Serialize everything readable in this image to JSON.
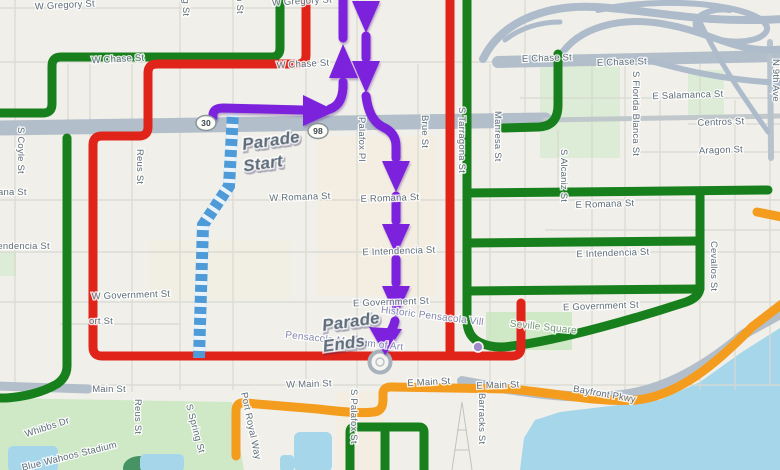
{
  "map": {
    "title": "Pensacola parade route map",
    "annotations": {
      "start_line1": "Parade",
      "start_line2": "Start",
      "ends_line1": "Parade",
      "ends_line2": "Ends"
    },
    "colors": {
      "parade_purple": "#7c22dd",
      "closure_red": "#e02419",
      "route_green": "#17801c",
      "route_orange": "#f49c1e",
      "staging_blue": "#4e9bd8",
      "road_gray": "#b2bfca",
      "ramp_gray": "#adbbcb",
      "water": "#a6d6ea",
      "park": "#cfe8c6",
      "background": "#f1efe9",
      "label_gray": "#5f6e7a",
      "parade_start_text": "#6d22c0",
      "parade_ends_text": "#4632ae"
    },
    "shields": [
      {
        "label": "30",
        "x": 206,
        "y": 123
      },
      {
        "label": "98",
        "x": 318,
        "y": 131
      }
    ],
    "street_labels": [
      {
        "text": "W Gregory St",
        "x": 65,
        "y": 8,
        "rot": -3
      },
      {
        "text": "W Gregory St",
        "x": 302,
        "y": 4,
        "rot": -3
      },
      {
        "text": "W Chase St",
        "x": 118,
        "y": 62,
        "rot": -3
      },
      {
        "text": "W Chase St",
        "x": 303,
        "y": 67,
        "rot": -3
      },
      {
        "text": "E Chase St",
        "x": 547,
        "y": 61,
        "rot": -2
      },
      {
        "text": "E Chase St",
        "x": 622,
        "y": 65,
        "rot": -2
      },
      {
        "text": "E Salamanca St",
        "x": 688,
        "y": 98,
        "rot": -2
      },
      {
        "text": "Centros St",
        "x": 721,
        "y": 125,
        "rot": -2
      },
      {
        "text": "Aragon St",
        "x": 721,
        "y": 153,
        "rot": -2
      },
      {
        "text": "W Romana St",
        "x": -4,
        "y": 195,
        "rot": 0
      },
      {
        "text": "W Romana St",
        "x": 300,
        "y": 200,
        "rot": -2
      },
      {
        "text": "E Romana St",
        "x": 390,
        "y": 201,
        "rot": -2
      },
      {
        "text": "E Romana St",
        "x": 605,
        "y": 207,
        "rot": -2
      },
      {
        "text": "W Intendencia St",
        "x": 12,
        "y": 249,
        "rot": 0
      },
      {
        "text": "E Intendencia St",
        "x": 399,
        "y": 254,
        "rot": -2
      },
      {
        "text": "E Intendencia St",
        "x": 613,
        "y": 256,
        "rot": -2
      },
      {
        "text": "W Government St",
        "x": 131,
        "y": 298,
        "rot": -2
      },
      {
        "text": "E Government St",
        "x": 391,
        "y": 305,
        "rot": -2
      },
      {
        "text": "E Government St",
        "x": 601,
        "y": 309,
        "rot": -2
      },
      {
        "text": "ort St",
        "x": 101,
        "y": 324,
        "rot": 0
      },
      {
        "text": "Main St",
        "x": 109,
        "y": 392,
        "rot": 0
      },
      {
        "text": "W Main St",
        "x": 309,
        "y": 387,
        "rot": -2
      },
      {
        "text": "E Main St",
        "x": 429,
        "y": 385,
        "rot": -3
      },
      {
        "text": "E Main St",
        "x": 498,
        "y": 388,
        "rot": -2
      },
      {
        "text": "Bayfront Pkwy",
        "x": 604,
        "y": 397,
        "rot": 10
      },
      {
        "text": "Whibbs Dr",
        "x": 48,
        "y": 430,
        "rot": -18
      },
      {
        "text": "Blue Wahoos Stadium",
        "x": 70,
        "y": 459,
        "rot": -14
      },
      {
        "text": "S Coyle St",
        "x": 18,
        "y": 127,
        "rot": 90,
        "anchor": "start"
      },
      {
        "text": "Reus St",
        "x": 137,
        "y": 149,
        "rot": 90,
        "anchor": "start"
      },
      {
        "text": "S Spring St",
        "x": 183,
        "y": -34,
        "rot": 90,
        "anchor": "start"
      },
      {
        "text": "S Baylen St",
        "x": 237,
        "y": -38,
        "rot": 90,
        "anchor": "start"
      },
      {
        "text": "Palafox Pl",
        "x": 359,
        "y": 117,
        "rot": 90,
        "anchor": "start"
      },
      {
        "text": "Brue St",
        "x": 422,
        "y": 115,
        "rot": 90,
        "anchor": "start"
      },
      {
        "text": "S Tarragona St",
        "x": 459,
        "y": 107,
        "rot": 90,
        "anchor": "start"
      },
      {
        "text": "Manresa St",
        "x": 495,
        "y": 111,
        "rot": 90,
        "anchor": "start"
      },
      {
        "text": "S Alcaniz St",
        "x": 561,
        "y": 149,
        "rot": 90,
        "anchor": "start"
      },
      {
        "text": "S Florida Blanca St",
        "x": 633,
        "y": 71,
        "rot": 90,
        "anchor": "start"
      },
      {
        "text": "N 9th Ave",
        "x": 773,
        "y": 59,
        "rot": 90,
        "anchor": "start"
      },
      {
        "text": "Cevallos St",
        "x": 711,
        "y": 241,
        "rot": 90,
        "anchor": "start"
      },
      {
        "text": "Barracks St",
        "x": 479,
        "y": 393,
        "rot": 90,
        "anchor": "start"
      },
      {
        "text": "S Palafox St",
        "x": 351,
        "y": 389,
        "rot": 90,
        "anchor": "start"
      },
      {
        "text": "Reus St",
        "x": 135,
        "y": 399,
        "rot": 90,
        "anchor": "start"
      },
      {
        "text": "S Spring St",
        "x": 186,
        "y": 405,
        "rot": 75,
        "anchor": "start"
      },
      {
        "text": "Port Royal Way",
        "x": 241,
        "y": 393,
        "rot": 78,
        "anchor": "start"
      }
    ],
    "poi_labels": [
      {
        "text": "Historic Pensacola Vill",
        "x": 432,
        "y": 319,
        "rot": 7,
        "cls": "poi"
      },
      {
        "text": "Pensacola Museum of Art",
        "x": 344,
        "y": 344,
        "rot": 6,
        "cls": "poi"
      },
      {
        "text": "Seville Square",
        "x": 543,
        "y": 330,
        "rot": 6,
        "cls": "poi-green"
      }
    ]
  }
}
